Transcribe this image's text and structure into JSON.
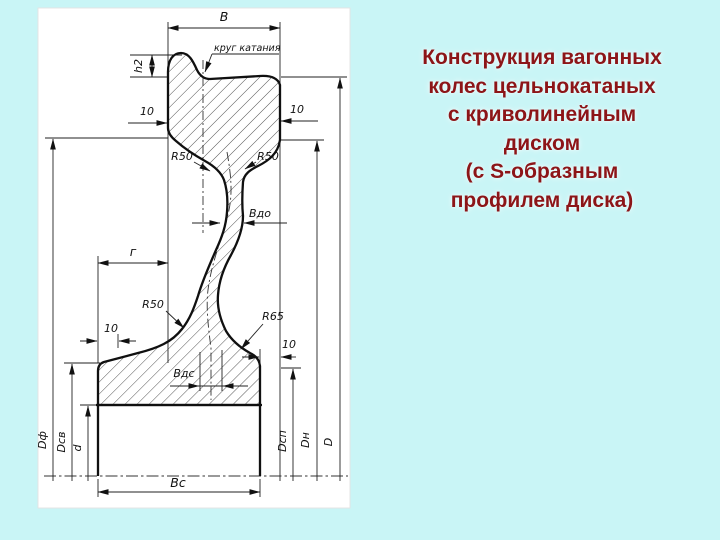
{
  "title": {
    "lines": [
      "Конструкция вагонных",
      "колес цельнокатаных",
      "с криволинейным",
      "диском",
      "(с S-образным",
      "профилем диска)"
    ],
    "color": "#8c1518"
  },
  "drawing": {
    "labels": {
      "rim_width": "В",
      "rolling_circle_note": "круг катания",
      "flange_height": "h2",
      "taper_top_left": "10",
      "taper_top_right": "10",
      "radius_top_left": "R50",
      "radius_top_right": "R50",
      "disc_thickness_rim": "Вдо",
      "g_dim": "г",
      "radius_bottom_left": "R50",
      "radius_bottom_right": "R65",
      "offset_bottom_left": "10",
      "offset_bottom_right": "10",
      "disc_thickness_hub": "Вдс",
      "hub_width": "Вс",
      "dia_left_outer": "Dф",
      "dia_left_mid": "Dсв",
      "dia_bore": "d",
      "dia_right_inner": "Dсп",
      "dia_right_mid": "Dн",
      "dia_rolling": "D"
    },
    "colors": {
      "background": "#c9f5f6",
      "panel": "#ffffff",
      "line": "#101010",
      "title_text": "#8c1518"
    }
  }
}
